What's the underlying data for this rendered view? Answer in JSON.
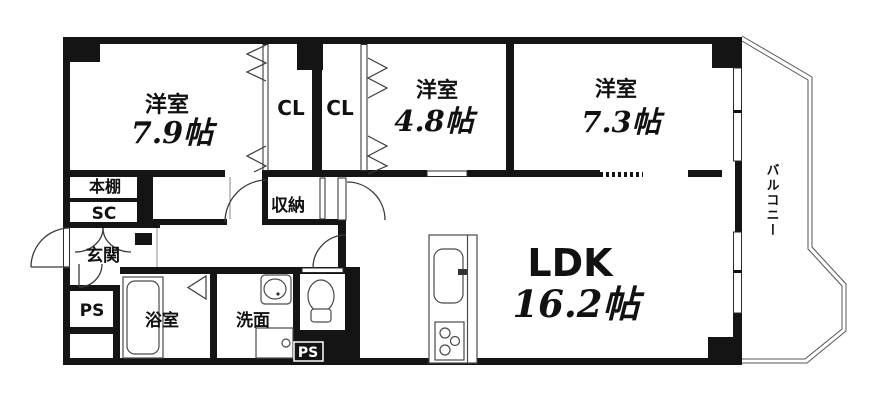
{
  "floorplan": {
    "title": "apartment-floor-plan",
    "colors": {
      "wall": "#141414",
      "background": "#ffffff",
      "line": "#3a3a3a"
    },
    "rooms": {
      "western1": {
        "label": "洋室",
        "size": "7.9帖"
      },
      "western2": {
        "label": "洋室",
        "size": "4.8帖"
      },
      "western3": {
        "label": "洋室",
        "size": "7.3帖"
      },
      "ldk": {
        "label": "LDK",
        "size": "16.2帖"
      },
      "closet1": {
        "label": "CL"
      },
      "closet2": {
        "label": "CL"
      },
      "storage": {
        "label": "収納"
      },
      "bookshelf": {
        "label": "本棚"
      },
      "shoe_closet": {
        "label": "SC"
      },
      "entrance": {
        "label": "玄関"
      },
      "bathroom": {
        "label": "浴室"
      },
      "washroom": {
        "label": "洗面"
      },
      "pipe_space_left": {
        "label": "PS"
      },
      "pipe_space_bottom": {
        "label": "PS"
      },
      "balcony": {
        "label": "バルコニー"
      }
    }
  }
}
